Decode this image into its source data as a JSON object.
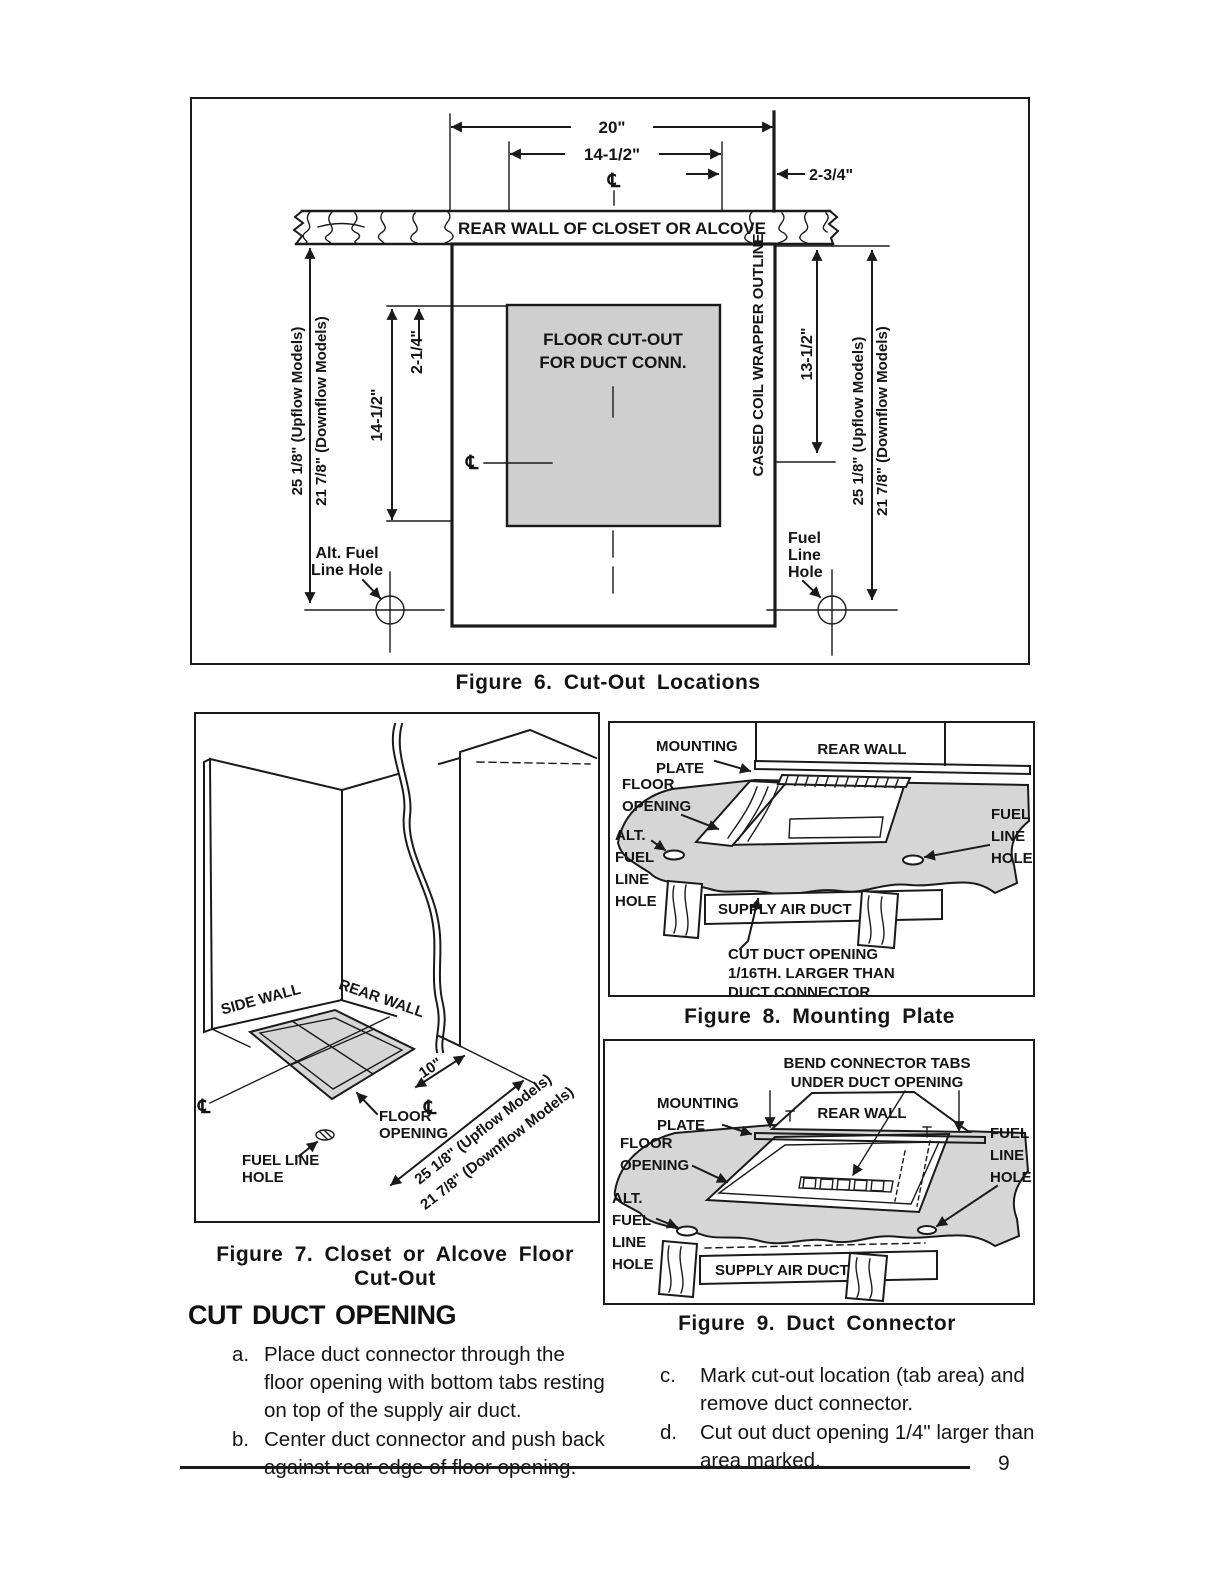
{
  "shared": {
    "upflow": "25 1/8\" (Upflow Models)",
    "downflow": "21 7/8\" (Downflow Models)",
    "centerline": "℄"
  },
  "figure6": {
    "caption": "Figure 6. Cut-Out Locations",
    "dim_20": "20\"",
    "dim_14_top": "14-1/2\"",
    "dim_2_34": "2-3/4\"",
    "dim_2_14": "2-1/4\"",
    "dim_14_left": "14-1/2\"",
    "dim_13_12": "13-1/2\"",
    "rear_wall": "REAR WALL OF CLOSET OR ALCOVE",
    "cutout_1": "FLOOR CUT-OUT",
    "cutout_2": "FOR DUCT CONN.",
    "cased_coil": "CASED COIL WRAPPER OUTLINE",
    "alt_fuel_1": "Alt. Fuel",
    "alt_fuel_2": "Line Hole",
    "fuel_1": "Fuel",
    "fuel_2": "Line",
    "fuel_3": "Hole"
  },
  "figure7": {
    "caption": "Figure 7. Closet or Alcove Floor Cut-Out",
    "side_wall": "SIDE WALL",
    "rear_wall": "REAR WALL",
    "dim_10": "10\"",
    "floor_1": "FLOOR",
    "floor_2": "OPENING",
    "fuel_1": "FUEL LINE",
    "fuel_2": "HOLE"
  },
  "figure8": {
    "caption": "Figure 8. Mounting Plate",
    "mounting_1": "MOUNTING",
    "mounting_2": "PLATE",
    "rear_wall": "REAR WALL",
    "floor_1": "FLOOR",
    "floor_2": "OPENING",
    "alt_1": "ALT.",
    "alt_2": "FUEL",
    "alt_3": "LINE",
    "alt_4": "HOLE",
    "fuel_1": "FUEL",
    "fuel_2": "LINE",
    "fuel_3": "HOLE",
    "supply": "SUPPLY AIR DUCT",
    "cut_1": "CUT DUCT OPENING",
    "cut_2": "1/16TH. LARGER THAN",
    "cut_3": "DUCT CONNECTOR"
  },
  "figure9": {
    "caption": "Figure 9. Duct Connector",
    "bend_1": "BEND CONNECTOR TABS",
    "bend_2": "UNDER DUCT OPENING",
    "mounting_1": "MOUNTING",
    "mounting_2": "PLATE",
    "rear_wall": "REAR WALL",
    "floor_1": "FLOOR",
    "floor_2": "OPENING",
    "alt_1": "ALT.",
    "alt_2": "FUEL",
    "alt_3": "LINE",
    "alt_4": "HOLE",
    "fuel_1": "FUEL",
    "fuel_2": "LINE",
    "fuel_3": "HOLE",
    "supply": "SUPPLY AIR DUCT"
  },
  "section": {
    "heading": "CUT DUCT OPENING",
    "items_left": [
      {
        "letter": "a.",
        "text": "Place duct connector through the floor opening with bottom tabs resting on top of the supply air duct."
      },
      {
        "letter": "b.",
        "text": "Center duct connector and push back against rear edge of floor opening."
      }
    ],
    "items_right": [
      {
        "letter": "c.",
        "text": "Mark cut-out location (tab area) and remove duct connector."
      },
      {
        "letter": "d.",
        "text": "Cut out duct opening 1/4\" larger than area marked."
      }
    ]
  },
  "footer": {
    "page_number": "9"
  }
}
